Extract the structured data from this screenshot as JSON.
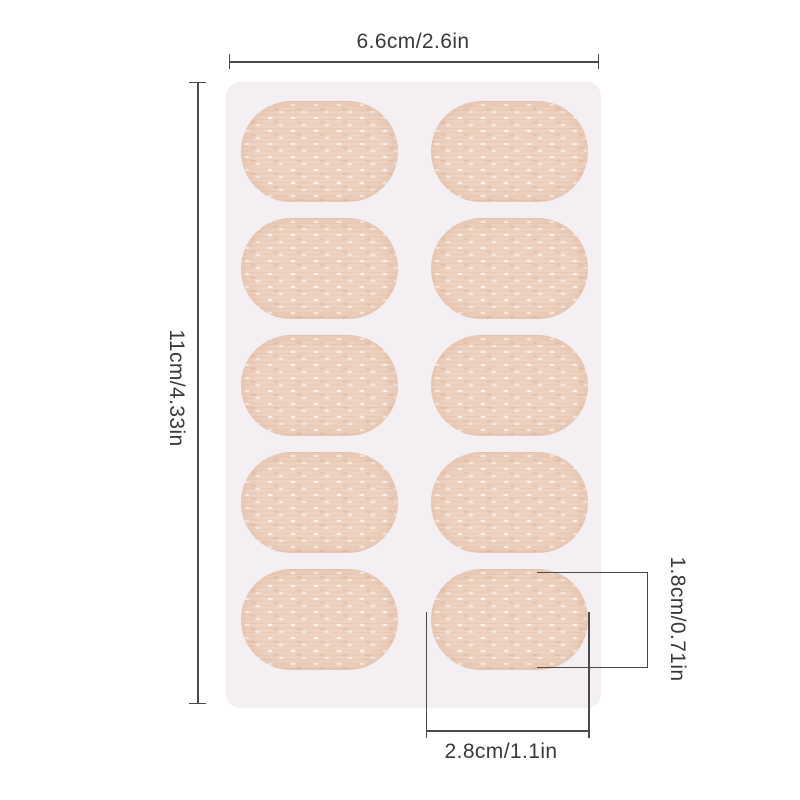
{
  "image": {
    "type": "product-photo-with-dimension-annotations",
    "subject": "white backing sheet holding 10 oval beige non-woven adhesive patches in a 2x5 grid"
  },
  "annotations": {
    "sheet_width": "6.6cm/2.6in",
    "sheet_height": "11cm/4.33in",
    "patch_height": "1.8cm/0.71in",
    "patch_width": "2.8cm/1.1in"
  },
  "sheet": {
    "rows": 5,
    "cols": 2,
    "patch_count": 10
  },
  "colors": {
    "background": "#ffffff",
    "sheet": "#f4eff3",
    "patch": "#eed3c2",
    "line": "#4a4a4a",
    "text": "#3a3a3a"
  }
}
